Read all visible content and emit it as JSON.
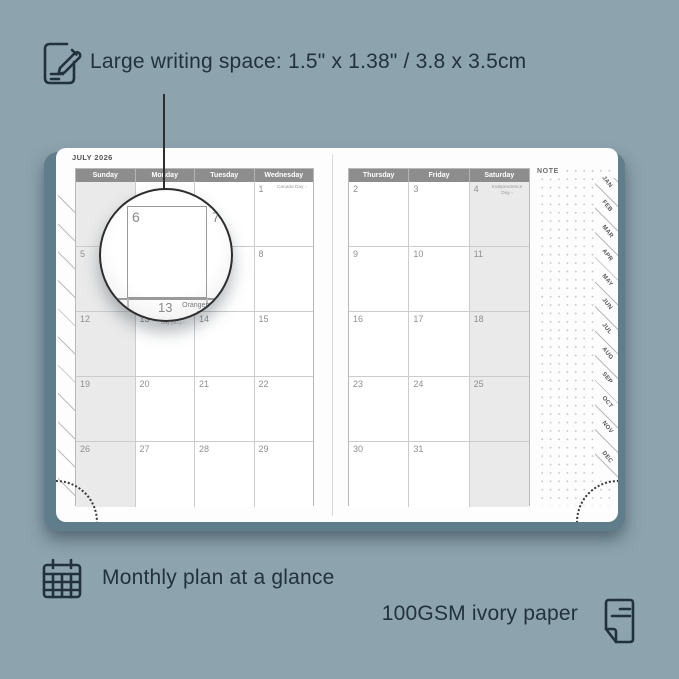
{
  "annotations": {
    "top_text": "Large writing space: 1.5\" x 1.38\" / 3.8 x 3.5cm",
    "bottom_left_text": "Monthly plan at a glance",
    "bottom_right_text": "100GSM ivory paper"
  },
  "icons": [
    "pencil-note-icon",
    "calendar-grid-icon",
    "paper-sheet-icon"
  ],
  "colors": {
    "background": "#8DA3AE",
    "ink": "#22323D",
    "cover": "#607D8B",
    "header_bar": "#8D8D8D",
    "weekend_fill": "#EAEAEA",
    "grid_border": "#CCCCCC"
  },
  "planner": {
    "month_title": "JULY 2026",
    "note_label": "NOTE",
    "day_headers_left": [
      "Sunday",
      "Monday",
      "Tuesday",
      "Wednesday"
    ],
    "day_headers_right": [
      "Thursday",
      "Friday",
      "Saturday"
    ],
    "month_tabs": [
      "JAN",
      "FEB",
      "MAR",
      "APR",
      "MAY",
      "JUN",
      "JUL",
      "AUG",
      "SEP",
      "OCT",
      "NOV",
      "DEC"
    ],
    "left_rows": [
      [
        {
          "d": "",
          "h": ""
        },
        {
          "d": "",
          "h": ""
        },
        {
          "d": "",
          "h": ""
        },
        {
          "d": "1",
          "h": "Canada Day ▫"
        }
      ],
      [
        {
          "d": "5",
          "h": ""
        },
        {
          "d": "6",
          "h": ""
        },
        {
          "d": "7",
          "h": ""
        },
        {
          "d": "8",
          "h": ""
        }
      ],
      [
        {
          "d": "12",
          "h": ""
        },
        {
          "d": "13",
          "h": "Orangemen's Day (N.I.) ▫"
        },
        {
          "d": "14",
          "h": ""
        },
        {
          "d": "15",
          "h": ""
        }
      ],
      [
        {
          "d": "19",
          "h": ""
        },
        {
          "d": "20",
          "h": ""
        },
        {
          "d": "21",
          "h": ""
        },
        {
          "d": "22",
          "h": ""
        }
      ],
      [
        {
          "d": "26",
          "h": ""
        },
        {
          "d": "27",
          "h": ""
        },
        {
          "d": "28",
          "h": ""
        },
        {
          "d": "29",
          "h": ""
        }
      ]
    ],
    "right_rows": [
      [
        {
          "d": "2",
          "h": ""
        },
        {
          "d": "3",
          "h": ""
        },
        {
          "d": "4",
          "h": "Independence Day ▫"
        }
      ],
      [
        {
          "d": "9",
          "h": ""
        },
        {
          "d": "10",
          "h": ""
        },
        {
          "d": "11",
          "h": ""
        }
      ],
      [
        {
          "d": "16",
          "h": ""
        },
        {
          "d": "17",
          "h": ""
        },
        {
          "d": "18",
          "h": ""
        }
      ],
      [
        {
          "d": "23",
          "h": ""
        },
        {
          "d": "24",
          "h": ""
        },
        {
          "d": "25",
          "h": ""
        }
      ],
      [
        {
          "d": "30",
          "h": ""
        },
        {
          "d": "31",
          "h": ""
        },
        {
          "d": "",
          "h": ""
        }
      ]
    ]
  },
  "zoom_bubble": {
    "day_left": "6",
    "day_right": "7",
    "day_bottom": "13",
    "holiday_line1": "Orangemen's Day",
    "holiday_line2": "(N.I.) ▫"
  }
}
